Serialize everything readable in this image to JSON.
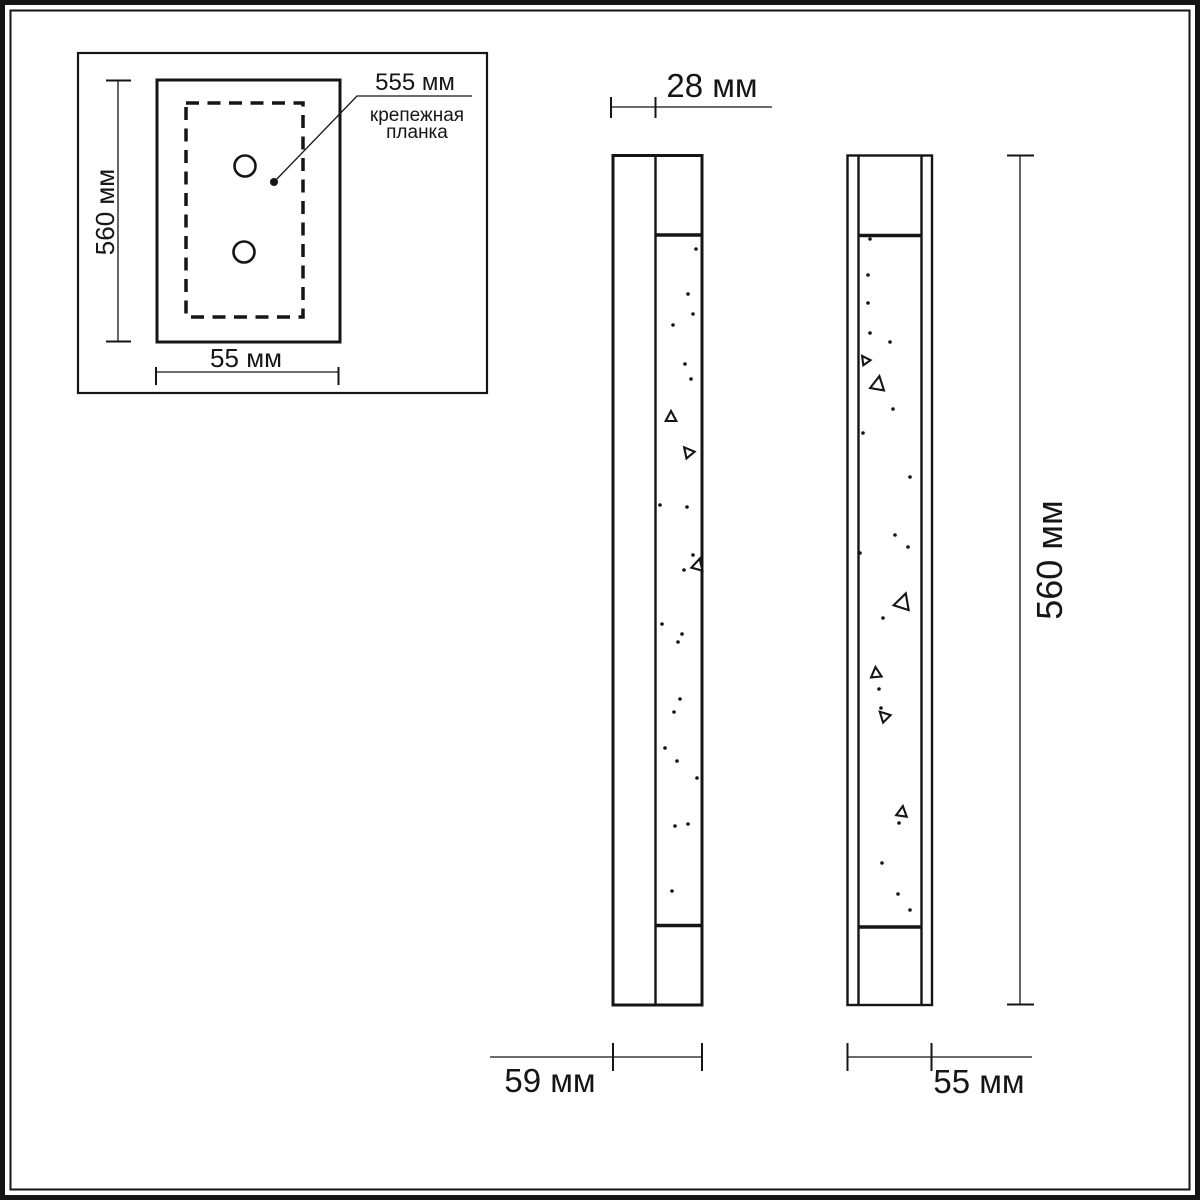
{
  "colors": {
    "line": "#151515",
    "background": "#ffffff"
  },
  "inset_detail": {
    "height_dim": "560 мм",
    "width_dim": "55 мм",
    "callout_dim": "555 мм",
    "callout_label_line1": "крепежная",
    "callout_label_line2": "планка"
  },
  "side_view": {
    "plate_depth_dim": "28 мм",
    "total_depth_dim": "59 мм"
  },
  "front_view": {
    "height_dim": "560 мм",
    "width_dim": "55 мм"
  }
}
